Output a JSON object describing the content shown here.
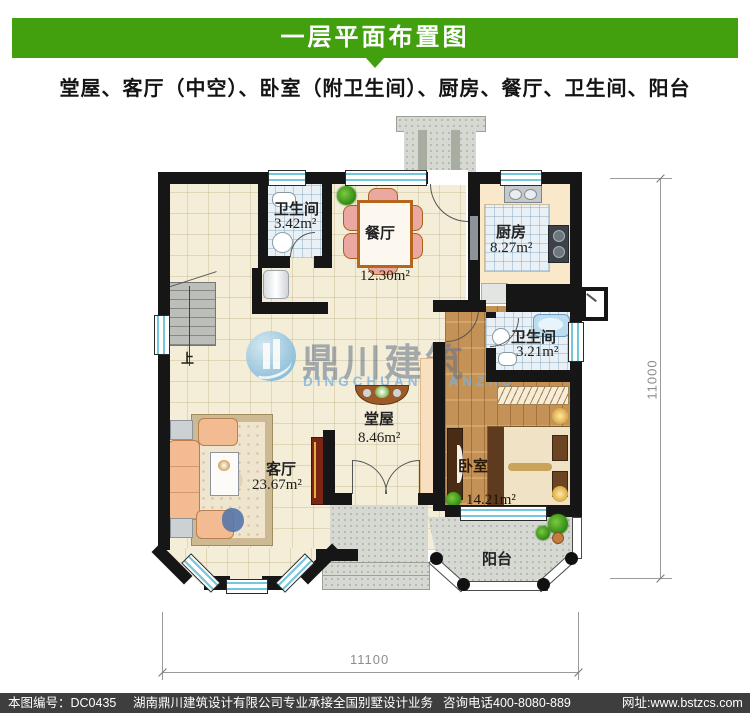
{
  "header": {
    "title": "一层平面布置图",
    "subtitle": "堂屋、客厅（中空）、卧室（附卫生间）、厨房、餐厅、卫生间、阳台"
  },
  "rooms": {
    "bath1": {
      "name": "卫生间",
      "area": "3.42m²"
    },
    "dining": {
      "name": "餐厅",
      "area": "12.30m²"
    },
    "kitchen": {
      "name": "厨房",
      "area": "8.27m²"
    },
    "bath2": {
      "name": "卫生间",
      "area": "3.21m²"
    },
    "hall": {
      "name": "堂屋",
      "area": "8.46m²"
    },
    "living": {
      "name": "客厅",
      "area": "23.67m²"
    },
    "bedroom": {
      "name": "卧室",
      "area": "14.21m²"
    },
    "balcony": {
      "name": "阳台"
    }
  },
  "stairs": {
    "up_label": "上"
  },
  "dimensions": {
    "bottom": "11100",
    "right": "11000"
  },
  "watermark": {
    "cn": "鼎川建筑",
    "en": "DINGCHUAN JIANZHU"
  },
  "footer": {
    "sheet_no": "本图编号：DC0435",
    "company": "湖南鼎川建筑设计有限公司专业承接全国别墅设计业务",
    "phone": "咨询电话400-8080-889",
    "website": "网址:www.bstzcs.com"
  },
  "colors": {
    "banner_green": "#42a00e",
    "footer_gray": "#3e3e3e",
    "wall_black": "#161616",
    "window_blue": "#74c6dd",
    "floor_beige": "#f4eed8",
    "tile_blue": "#e9f1f6",
    "wood_brown": "#c49257",
    "counter_peach": "#f9e8ca",
    "concrete_gray": "#d6d9d2",
    "watermark_blue": "#7db8dc",
    "dim_gray": "#9a9a9a"
  }
}
